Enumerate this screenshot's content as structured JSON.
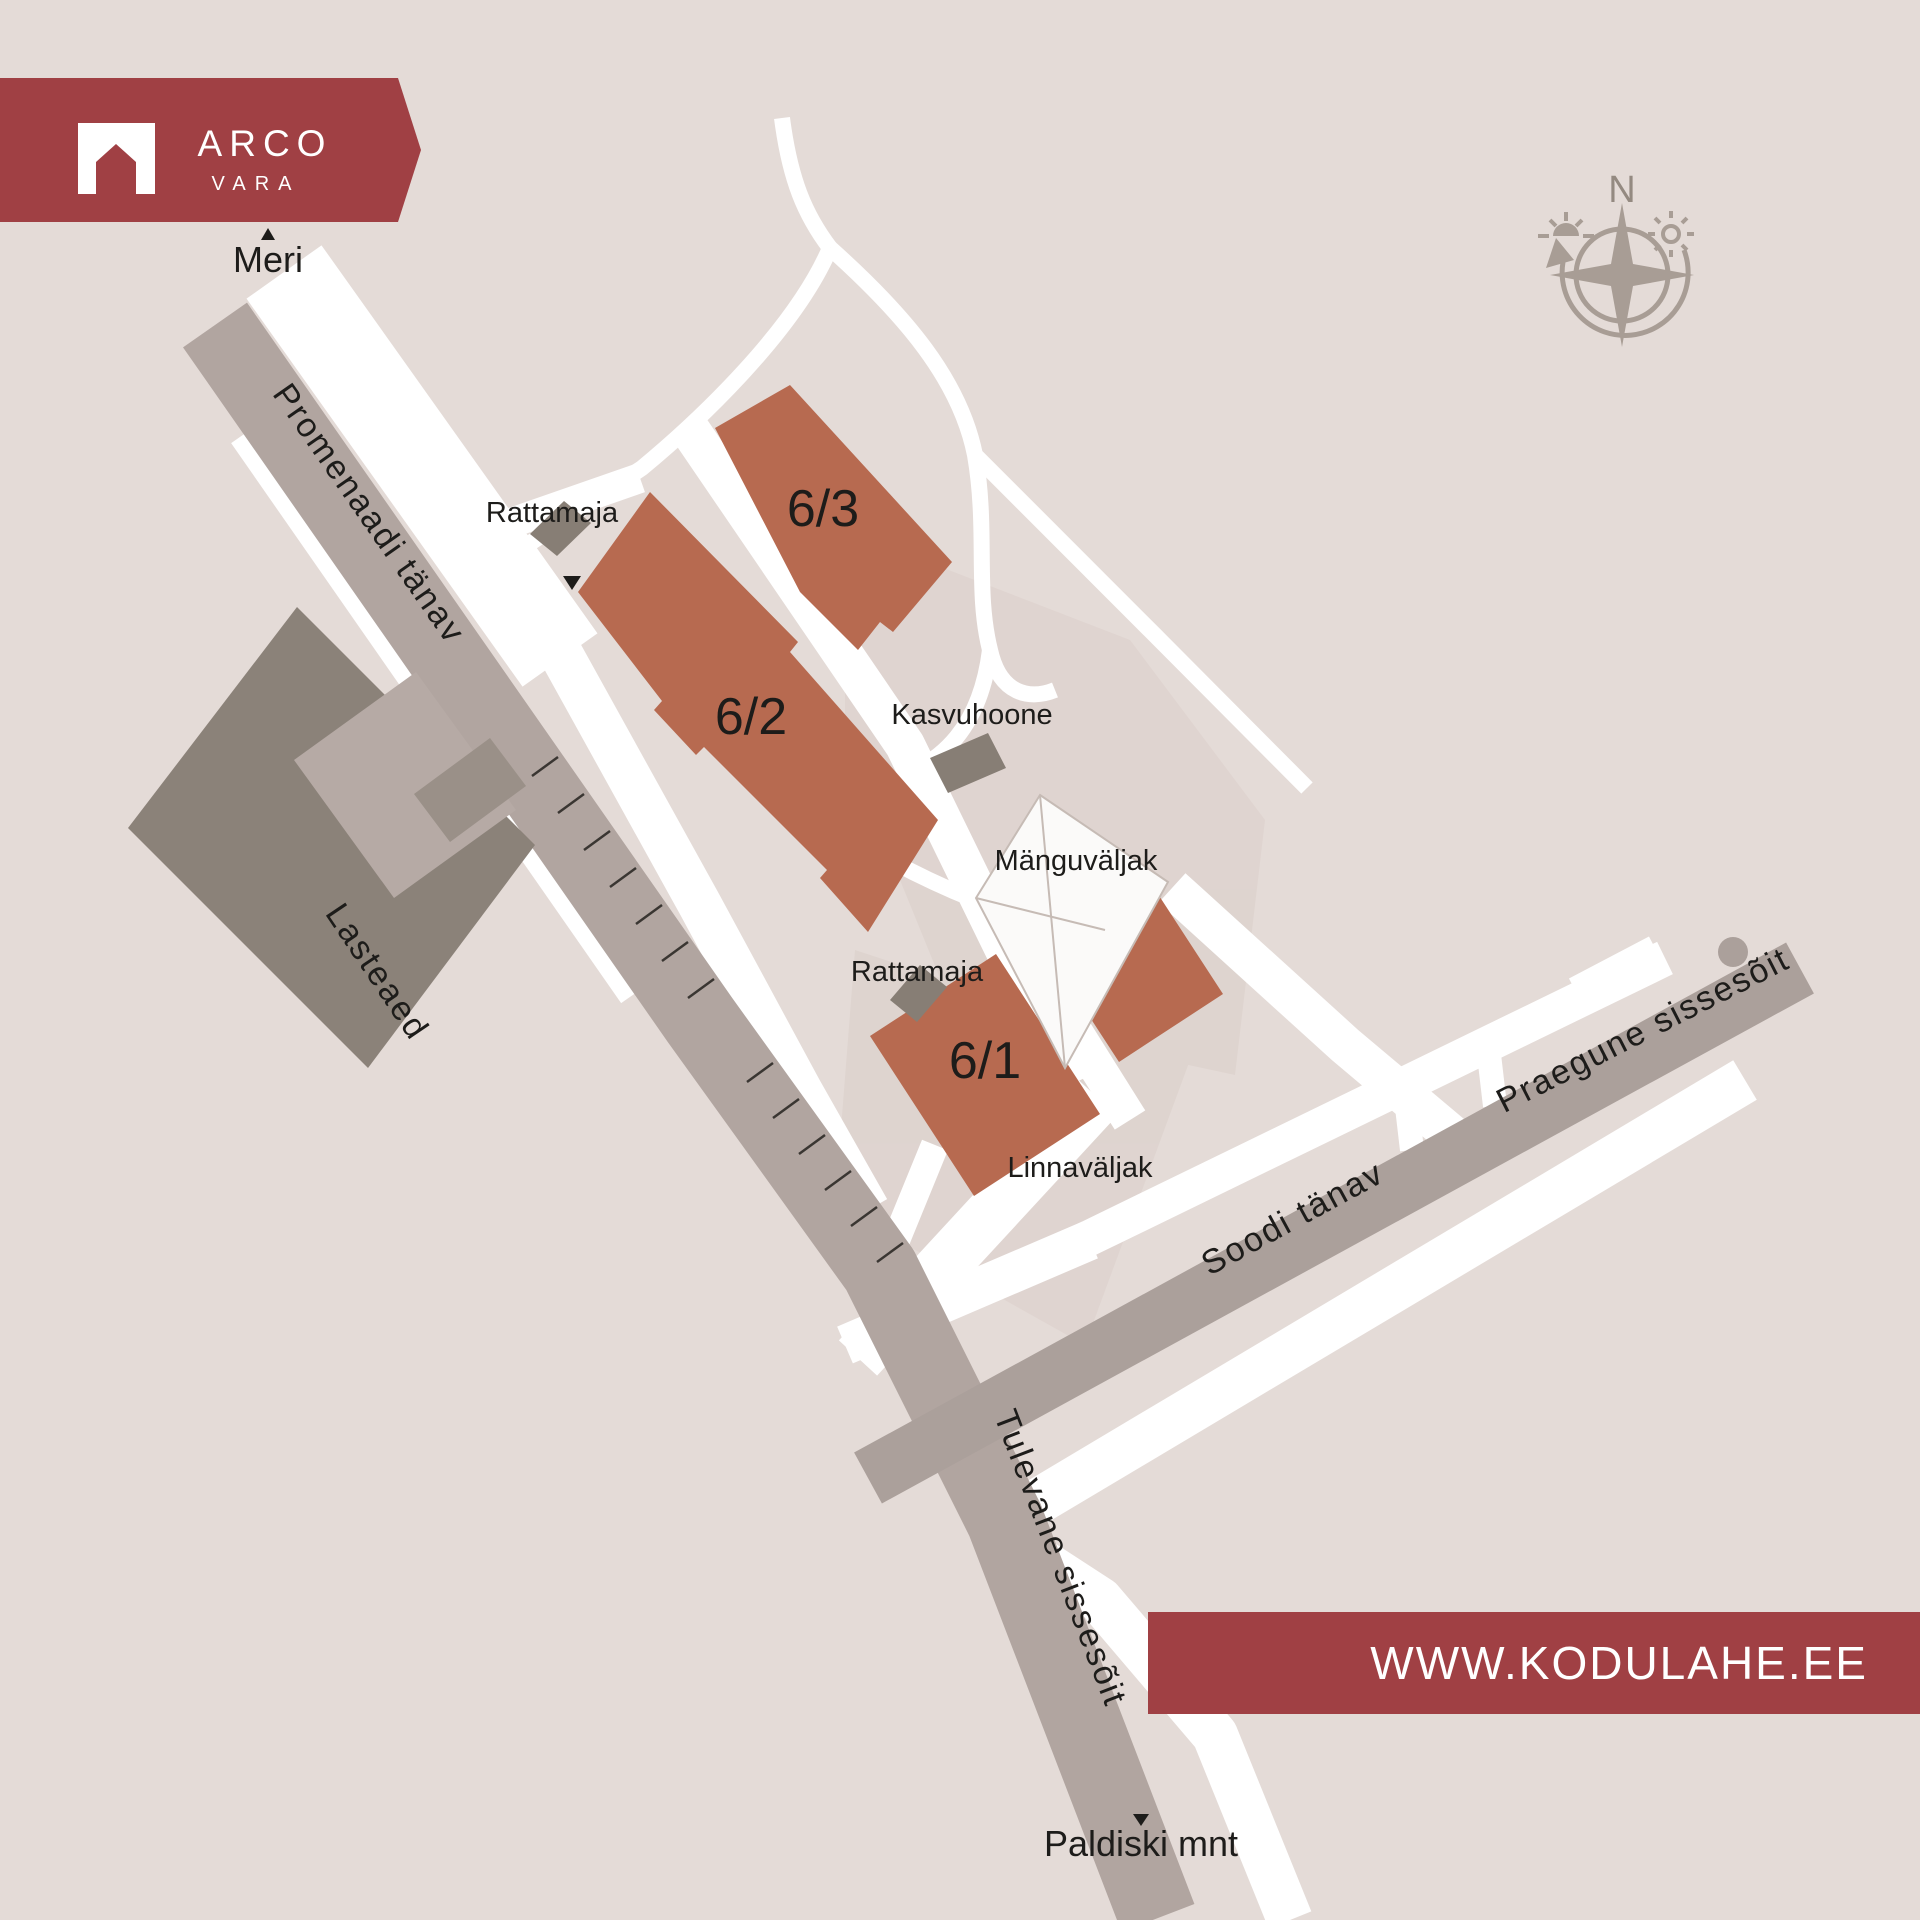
{
  "logo": {
    "brand": "ARCO",
    "sub": "VARA",
    "icon": "house-arch-icon"
  },
  "banner": {
    "url": "WWW.KODULAHE.EE"
  },
  "compass": {
    "north": "N",
    "icons": [
      "sunset-icon",
      "sun-icon",
      "rotation-arrow-icon"
    ]
  },
  "labels": {
    "meri": "Meri",
    "paldiski": "Paldiski mnt",
    "promenaadi": "Promenaadi tänav",
    "soodi": "Soodi tänav",
    "praegune": "Praegune sissesõit",
    "tulevane": "Tulevane sissesõit",
    "lasteaed": "Lasteaed",
    "rattamaja_north": "Rattamaja",
    "rattamaja_south": "Rattamaja",
    "kasvuhoone": "Kasvuhoone",
    "manguvaljak": "Mänguväljak",
    "linnavaljak": "Linnaväljak",
    "b63": "6/3",
    "b62": "6/2",
    "b61": "6/1"
  },
  "colors": {
    "brand_red": "#a04044",
    "building_orange": "#b76a50",
    "building_grey": "#877e75",
    "lasteaed_grey": "#8b8279",
    "road_grey": "#b1a5a0",
    "background": "#e4dbd7",
    "compass_grey": "#a89d95"
  }
}
